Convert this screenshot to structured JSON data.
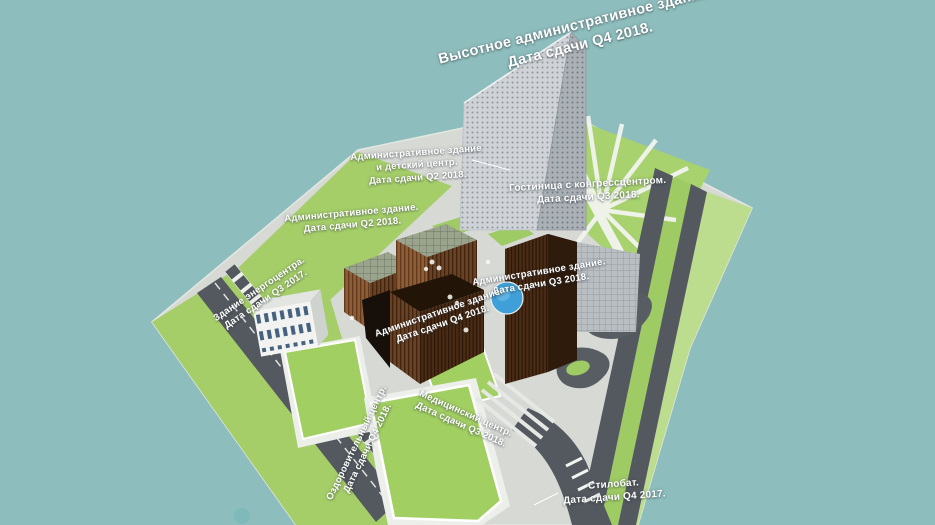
{
  "scene": {
    "type": "3d-masterplan-render",
    "background_color": "#8ebdbd"
  },
  "labels": {
    "highrise": {
      "line1": "Высотное административное здание.",
      "line2": "Дата сдачи Q4 2018."
    },
    "admin_kids": {
      "line1": "Административное здание",
      "line2": "и детский центр.",
      "line3": "Дата сдачи Q2 2018."
    },
    "hotel": {
      "line1": "Гостиница с конгрессцентром.",
      "line2": "Дата сдачи Q3 2018."
    },
    "admin_q2": {
      "line1": "Административное здание.",
      "line2": "Дата сдачи Q2 2018."
    },
    "admin_q3": {
      "line1": "Административное здание.",
      "line2": "Дата сдачи Q3 2018."
    },
    "admin_q4": {
      "line1": "Административное здание.",
      "line2": "Дата сдачи Q4 2018."
    },
    "energy": {
      "line1": "Здание энергоцентра.",
      "line2": "Дата сдачи Q3 2017."
    },
    "medical": {
      "line1": "Медицинский центр.",
      "line2": "Дата сдачи Q3 2018."
    },
    "wellness": {
      "line1": "Оздоровительный центр.",
      "line2": "Дата сдачи Q4 2018."
    },
    "stylobate": {
      "line1": "Стилобат.",
      "line2": "Дата сдачи Q4 2017."
    }
  },
  "colors": {
    "background": "#8ebdbd",
    "land": "#d7d9d5",
    "lawn": "#a5ce69",
    "lawn_light": "#bcdc8e",
    "road": "#54595f",
    "copper_facade": "#8f5c33",
    "copper_facade_dark": "#4a2c15",
    "tower_facade_light": "#cfd3d7",
    "tower_facade_dark": "#aab0b6",
    "fountain_blue": "#3f9fd8",
    "label_text": "#ffffff"
  }
}
